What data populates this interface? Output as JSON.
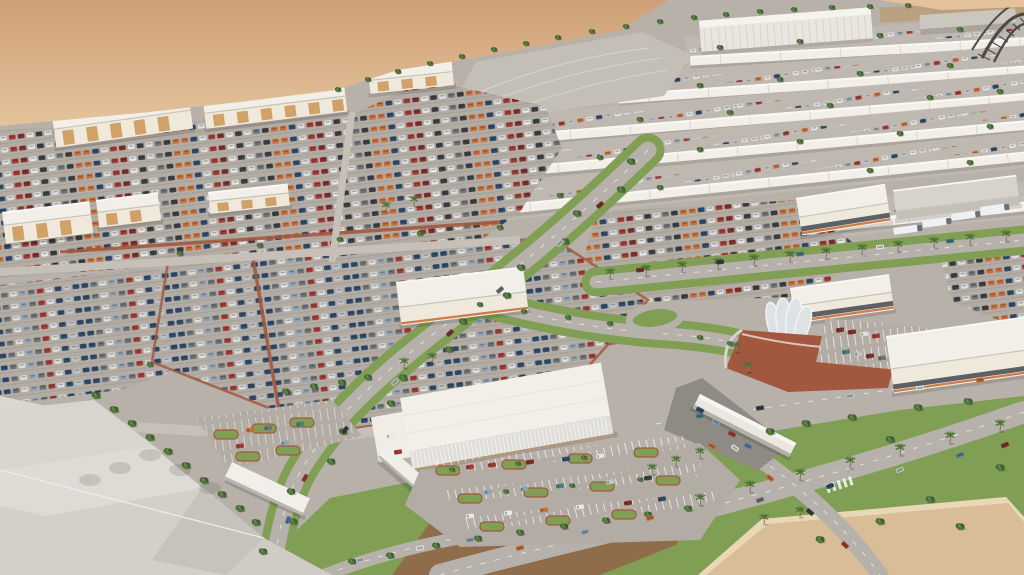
{
  "meta": {
    "title": "Aerial 3D rendering of a large automotive market complex",
    "type": "architectural visualization render",
    "visible_text": []
  },
  "scene": {
    "description": "Bird's-eye architectural render of a desert-edge car market: rows of long white sales sheds with car-filled lots (top right), dense multicolored car storage lots (left/center), showroom buildings with a curved glass rotunda and brick plaza (right), tree-lined curving boulevards, a large grey-roofed facility in the foreground (bottom left), a glass showroom with canopy walkway and customer parking (bottom center), road intersections with lawns, palms and a sand lot (bottom right), open desert (top left), and a dark lattice truss structure at the top right corner.",
    "regions": [
      {
        "name": "desert",
        "label": "open desert sand"
      },
      {
        "name": "perimeter-shops",
        "label": "white retail buildings along desert edge"
      },
      {
        "name": "shed-district",
        "label": "rows of long white car-sale sheds with parked cars"
      },
      {
        "name": "tent-warehouse",
        "label": "large ribbed white tent warehouse"
      },
      {
        "name": "truss-structure",
        "label": "dark lattice truss at top right corner"
      },
      {
        "name": "dense-car-lots",
        "label": "dense multicolored car storage lots"
      },
      {
        "name": "orange-stripe-warehouse",
        "label": "white warehouse with orange stripe"
      },
      {
        "name": "rotunda-showroom",
        "label": "showroom with curved glass rotunda and brick plaza"
      },
      {
        "name": "green-boulevard",
        "label": "curving tree-lined boulevard"
      },
      {
        "name": "palm-road",
        "label": "palm-lined road"
      },
      {
        "name": "foreground-facility",
        "label": "large grey-roofed buildings in foreground"
      },
      {
        "name": "glass-showroom",
        "label": "white glass showroom with canopy walkway"
      },
      {
        "name": "customer-parking",
        "label": "striped customer parking with landscaped islands"
      },
      {
        "name": "road-intersection",
        "label": "road intersection with lawns and palms"
      },
      {
        "name": "sand-lot",
        "label": "empty sand lot at bottom right"
      }
    ]
  },
  "palette": {
    "sand_dark": "#cfa077",
    "sand_light": "#e4c39c",
    "sand_lot": "#d9bd96",
    "asphalt": "#b7b1a9",
    "asphalt_lot": "#b2aca4",
    "road": "#b6b1aa",
    "road_light": "#c6c0b8",
    "building_white": "#f2efe8",
    "building_shade": "#aaa49c",
    "facade_cream": "#efe9dc",
    "panel_tan": "#d0a168",
    "accent_orange": "#cf7b49",
    "roof_grey": "#d6d3cc",
    "grass": "#819e55",
    "tree_dark": "#3f5e31",
    "tree_mid": "#486b37",
    "tree_light": "#55793f",
    "palm_green": "#4d7238",
    "trunk": "#8a7357",
    "brick": "#a2583f",
    "dirt": "#8f6c4a",
    "glass_band": "#5d6165",
    "truss": "#4e4a45",
    "car_colors": [
      "#2e4a6b",
      "#5b7da0",
      "#a23b34",
      "#e8e8e6",
      "#c2c5c8",
      "#4a7d7d",
      "#3a3d42",
      "#7e2f2c",
      "#6e7478",
      "#8fa3b5",
      "#c96f3a",
      "#dfe0de"
    ],
    "car_colors_light": [
      "#e8e8e6",
      "#c2c5c8",
      "#5b7da0",
      "#a23b34",
      "#9aa4ae",
      "#d8d9d7",
      "#2e4a6b",
      "#c96f3a"
    ]
  }
}
